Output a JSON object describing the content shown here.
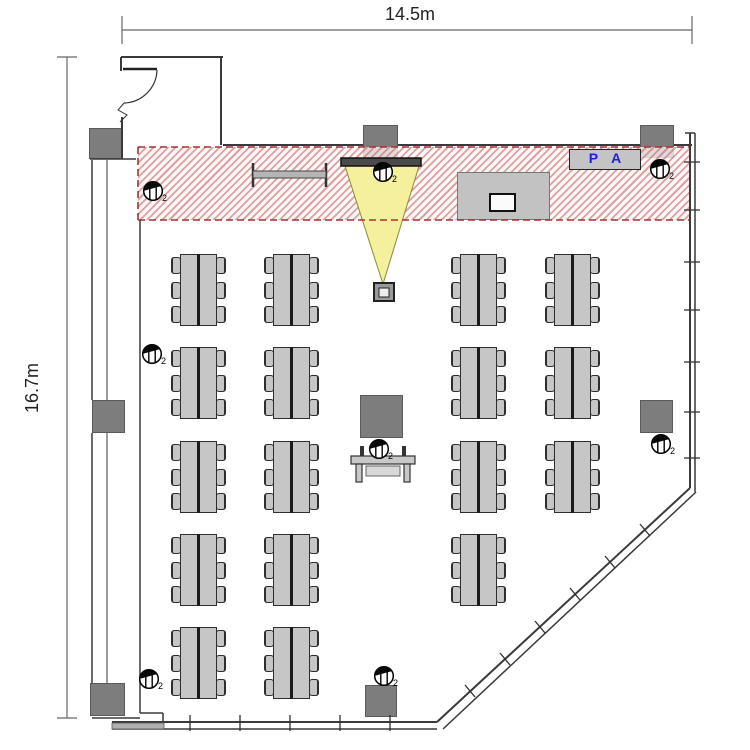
{
  "page": {
    "title": "seminar-room-floor-plan"
  },
  "dimensions": {
    "width_label": "14.5m",
    "height_label": "16.7m"
  },
  "stage": {
    "pa_label": "P A"
  },
  "symbols": {
    "outlet_subscript": "2"
  },
  "colors": {
    "hatch_stripe": "#c15c5c",
    "hatch_border_red": "#a63232",
    "beam_yellow": "#f4f09d",
    "pa_text_blue": "#1f1fd4",
    "pillar_gray": "#7d7d7d",
    "table_gray": "#c6c6c6",
    "wall_dark": "#3a3a3a"
  },
  "furniture": {
    "table_units": [
      {
        "x": 180,
        "y": 254
      },
      {
        "x": 273,
        "y": 254
      },
      {
        "x": 460,
        "y": 254
      },
      {
        "x": 554,
        "y": 254
      },
      {
        "x": 180,
        "y": 347
      },
      {
        "x": 273,
        "y": 347
      },
      {
        "x": 460,
        "y": 347
      },
      {
        "x": 554,
        "y": 347
      },
      {
        "x": 180,
        "y": 441
      },
      {
        "x": 273,
        "y": 441
      },
      {
        "x": 460,
        "y": 441
      },
      {
        "x": 554,
        "y": 441
      },
      {
        "x": 180,
        "y": 534
      },
      {
        "x": 273,
        "y": 534
      },
      {
        "x": 460,
        "y": 534
      },
      {
        "x": 180,
        "y": 627
      },
      {
        "x": 273,
        "y": 627
      }
    ],
    "pillars": [
      {
        "x": 89,
        "y": 128,
        "w": 34,
        "h": 31
      },
      {
        "x": 363,
        "y": 125,
        "w": 35,
        "h": 33
      },
      {
        "x": 640,
        "y": 125,
        "w": 34,
        "h": 33
      },
      {
        "x": 92,
        "y": 400,
        "w": 33,
        "h": 33
      },
      {
        "x": 90,
        "y": 683,
        "w": 35,
        "h": 33
      },
      {
        "x": 640,
        "y": 400,
        "w": 33,
        "h": 33
      },
      {
        "x": 365,
        "y": 685,
        "w": 32,
        "h": 32
      },
      {
        "x": 360,
        "y": 395,
        "w": 43,
        "h": 43
      }
    ],
    "outlets": [
      {
        "x": 153,
        "y": 191
      },
      {
        "x": 383,
        "y": 172
      },
      {
        "x": 660,
        "y": 169
      },
      {
        "x": 152,
        "y": 354
      },
      {
        "x": 149,
        "y": 679
      },
      {
        "x": 661,
        "y": 444
      },
      {
        "x": 379,
        "y": 449
      },
      {
        "x": 384,
        "y": 676
      }
    ]
  }
}
